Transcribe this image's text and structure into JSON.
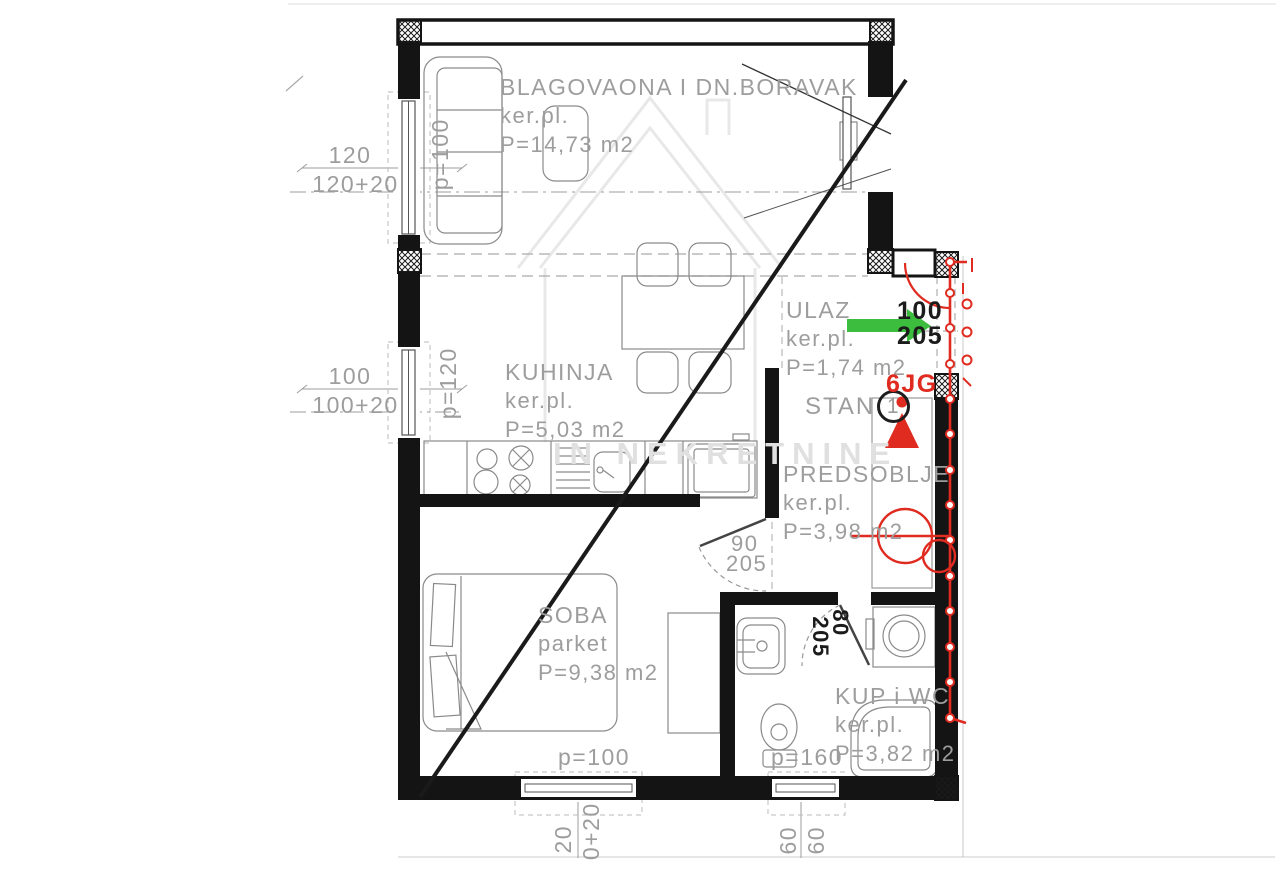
{
  "watermark": {
    "text": "IN NEKRETNINE"
  },
  "rooms": {
    "living": {
      "name": "BLAGOVAONA I DN.BORAVAK",
      "floor": "ker.pl.",
      "area": "P=14,73 m2"
    },
    "kitchen": {
      "name": "KUHINJA",
      "floor": "ker.pl.",
      "area": "P=5,03 m2"
    },
    "entry": {
      "name": "ULAZ",
      "floor": "ker.pl.",
      "area": "P=1,74 m2"
    },
    "hall": {
      "name": "PREDSOBLJE",
      "floor": "ker.pl.",
      "area": "P=3,98 m2"
    },
    "bedroom": {
      "name": "SOBA",
      "floor": "parket",
      "area": "P=9,38 m2"
    },
    "bathroom": {
      "name": "KUP i WC",
      "floor": "ker.pl.",
      "area": "P=3,82 m2"
    }
  },
  "unit": {
    "label": "STAN",
    "number": "1",
    "code": "6JG"
  },
  "doors": {
    "entry_door": {
      "width": "100",
      "height": "205"
    },
    "bedroom_door": {
      "width": "90",
      "height": "205"
    },
    "bathroom_door": {
      "width": "80",
      "height": "205"
    }
  },
  "dimensions": {
    "left_top": {
      "primary": "120",
      "secondary": "120+20",
      "sill": "p=100"
    },
    "left_bottom": {
      "primary": "100",
      "secondary": "100+20",
      "sill": "p=120"
    },
    "bottom_left_window": {
      "sill": "p=100",
      "clip_a": "20",
      "clip_b": "0+20"
    },
    "bottom_right_window": {
      "sill": "p=160",
      "a": "60",
      "b": "60"
    }
  },
  "colors": {
    "wall": "#141414",
    "dim_gray": "#9d9d9d",
    "accent_red": "#e02b20",
    "arrow_green": "#3dbd3d",
    "watermark_gray": "#e0e0e0"
  }
}
